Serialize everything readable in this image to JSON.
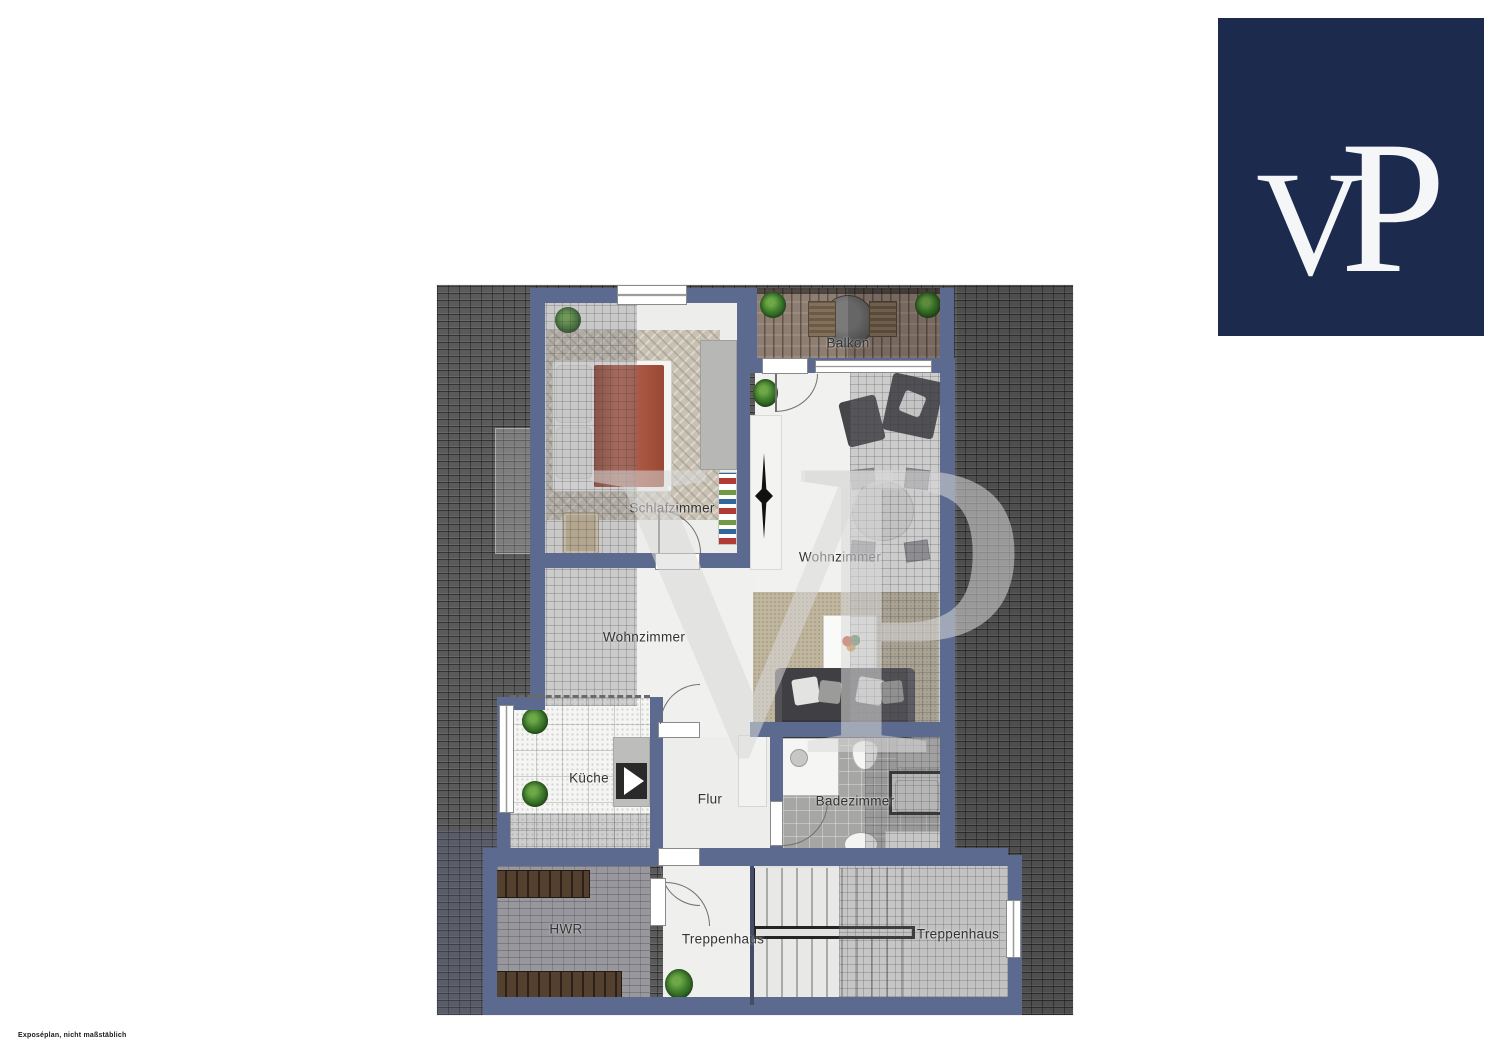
{
  "disclaimer": "Exposéplan, nicht maßstäblich",
  "watermark": "VP",
  "logo": {
    "letter_v": "V",
    "letter_p": "P"
  },
  "rooms": {
    "balkon": "Balkon",
    "schlafzimmer": "Schlafzimmer",
    "wohnzimmer_left": "Wohnzimmer",
    "wohnzimmer_right": "Wohnzimmer",
    "kueche": "Küche",
    "flur": "Flur",
    "badezimmer": "Badezimmer",
    "hwr": "HWR",
    "treppenhaus_left": "Treppenhaus",
    "treppenhaus_right": "Treppenhaus"
  },
  "colors": {
    "logo_bg": "#1c2b4d",
    "wall": "#5b6a8e",
    "roof_tile": "#5a5a5a",
    "bed_duvet": "#b2543c",
    "balcony_wood": "#8e7e72",
    "sofa": "#404044",
    "plant_green": "#3f7d2c",
    "floor": "#f0f0ee",
    "label_text": "#333333"
  }
}
